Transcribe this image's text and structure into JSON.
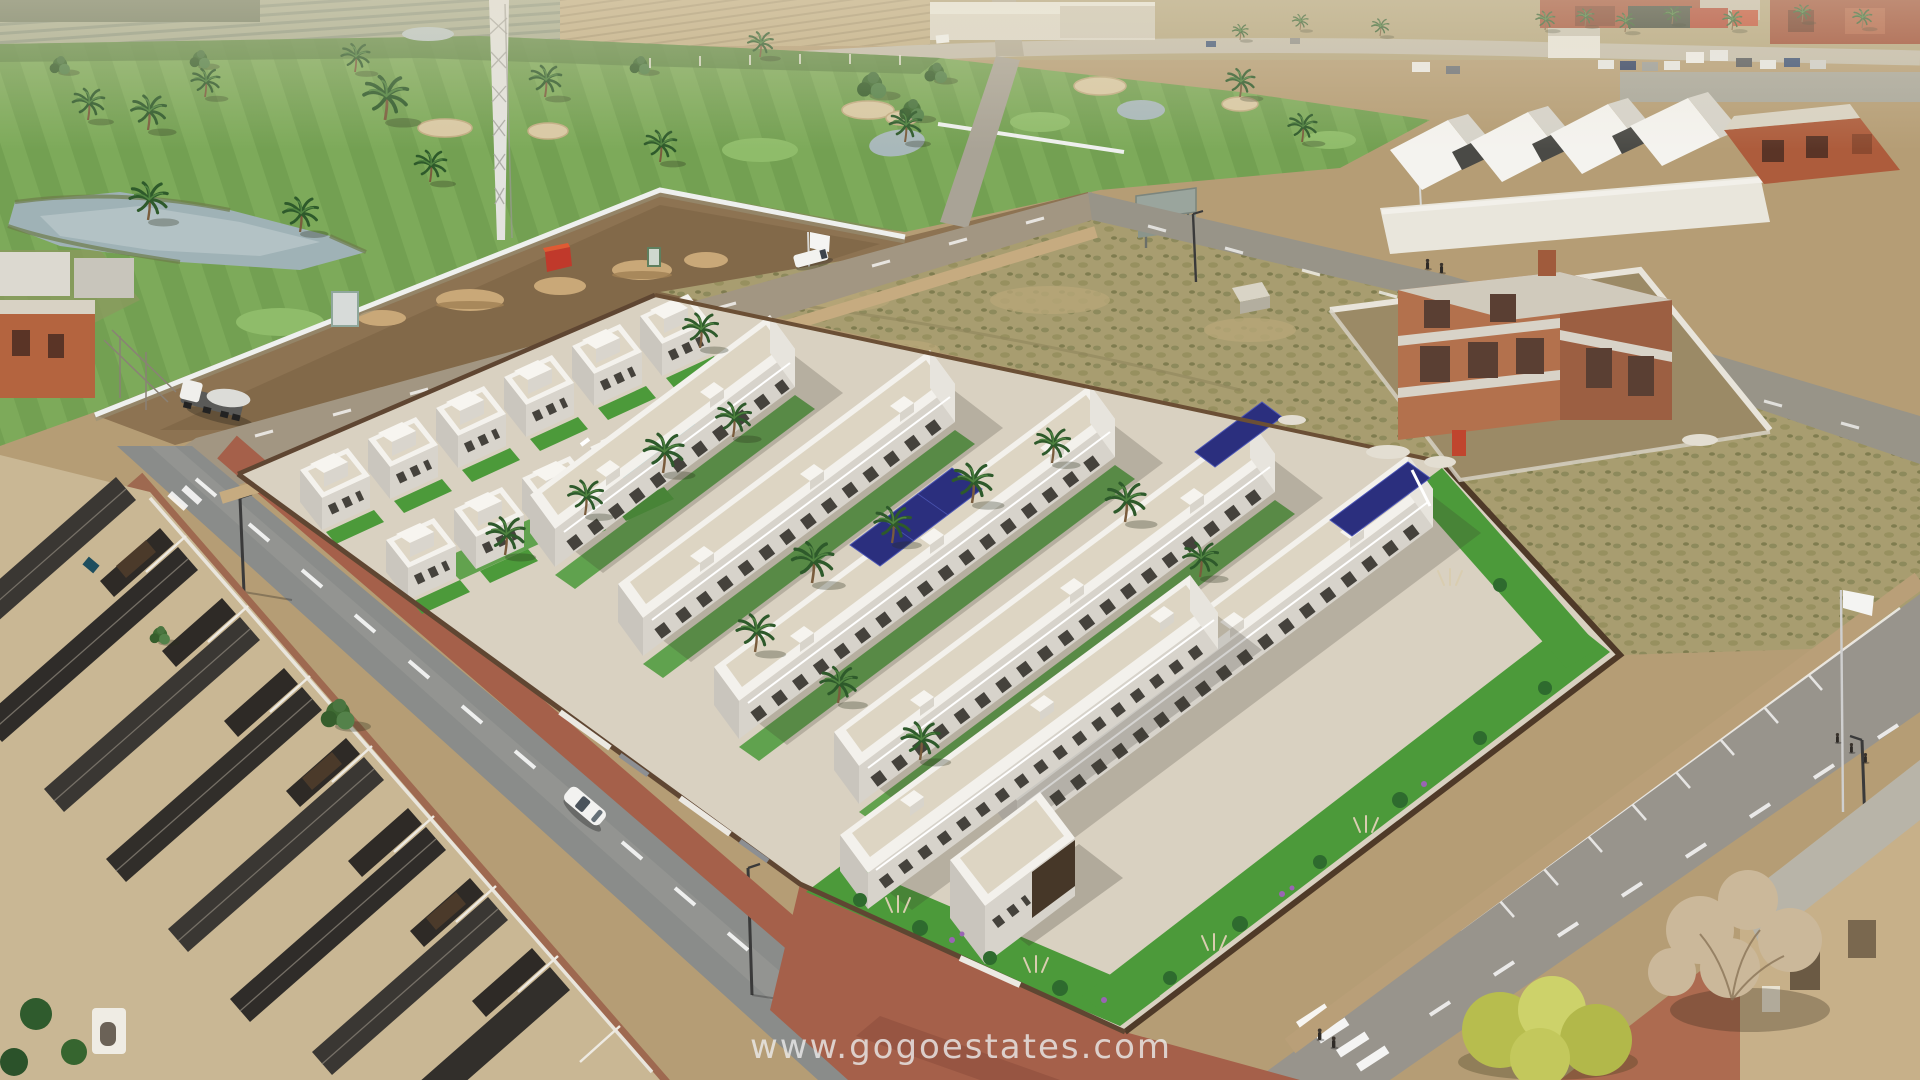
{
  "image": {
    "kind": "aerial-3d-render-photomontage",
    "description": "Aerial view of a new-build residential complex of white villas and townhouses with rooftop solar panels, rendered into a drone photo: golf course with ponds and palm trees at the upper left, dirt construction strip with a white boundary wall, cement truck and red container, vacant scrub plots and a brick house under construction to the right, existing dark-tile-roof houses at the lower left, asphalt roads with white lane markings, a white car, pedestrians, and a dry tree beside an old tan building at the lower right."
  },
  "watermark": {
    "text": "www.gogoestates.com",
    "color": "#ececec",
    "opacity": 0.8
  },
  "palette": {
    "golf_green": "#73a052",
    "pond_water": "#9fb2b6",
    "scrub_field": "#a89d70",
    "construction_dirt": "#8d7352",
    "asphalt": "#8f8f8c",
    "sidewalk_brick": "#a5604a",
    "sidewalk_tan": "#c6ab80",
    "development_white": "#f3f1ec",
    "development_shade": "#d5d1c9",
    "terrace_beige": "#ddd5c3",
    "solar_panel_navy": "#2b2f7e",
    "lawn_green": "#4c9a3a",
    "fence_brown": "#5f4632",
    "old_roof_charcoal": "#3a3733",
    "old_wall_cream": "#e3d8bd",
    "brick_construction": "#b3714d"
  },
  "scene": {
    "regions": [
      "golf-course",
      "construction-strip",
      "new-development",
      "vacant-plots",
      "old-town-roofs",
      "roads",
      "brick-house-under-construction",
      "distant-fields"
    ],
    "objects": [
      "tower-crane",
      "cement-truck",
      "red-container",
      "white-car",
      "white-van",
      "swimming-pool",
      "solar-panels",
      "palm-trees",
      "billboard",
      "flag-banner",
      "pedestrians",
      "street-lamps",
      "crosswalk",
      "dry-tree",
      "yellow-bush"
    ]
  }
}
